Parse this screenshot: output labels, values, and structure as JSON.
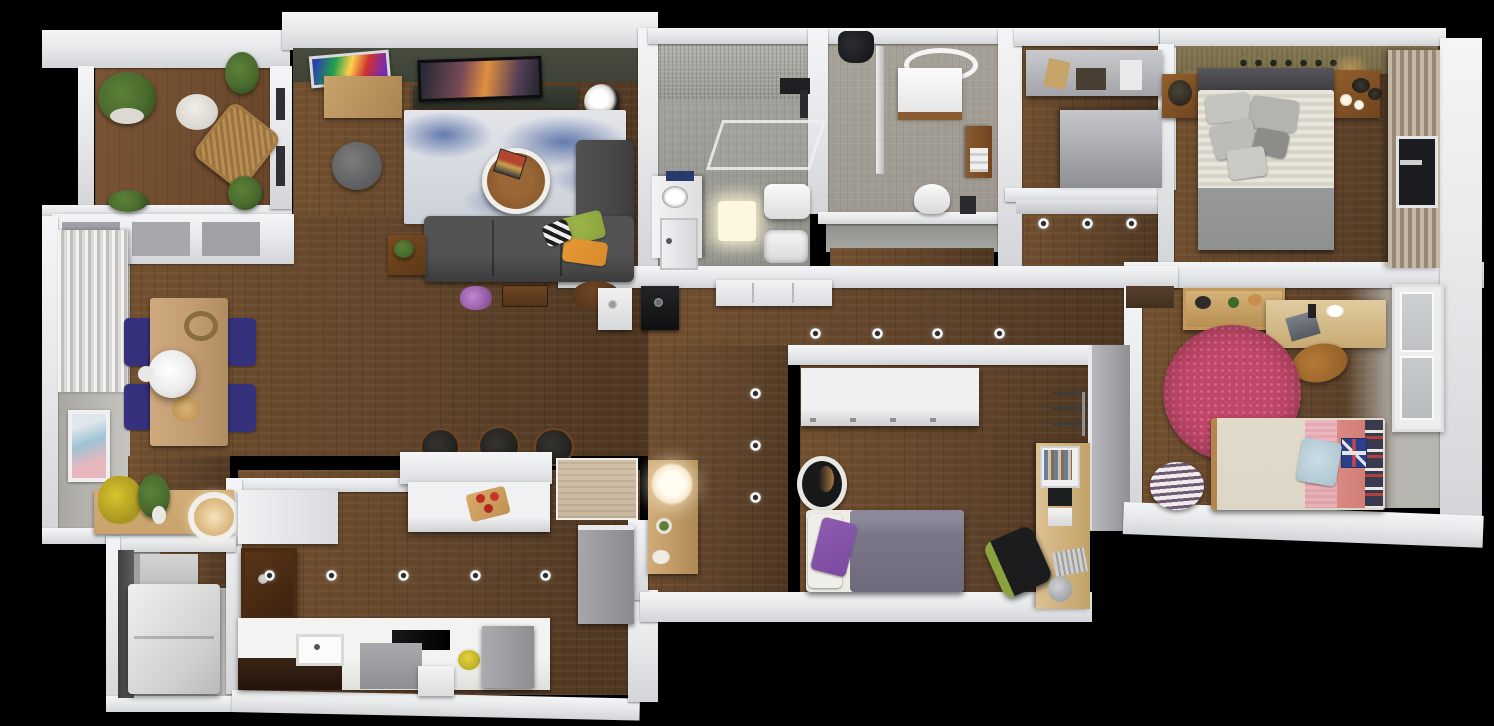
{
  "scene": {
    "type": "3d-floor-plan-top-down-render",
    "subject": "apartment-floor-plan",
    "background": "black",
    "visible_text": "none"
  },
  "palette": {
    "bg": "#000000",
    "wall": "#e8e9eb",
    "wood": "#5e422a",
    "woodDark": "#4c3520",
    "woodLight": "#73512f",
    "oliveWall": "#3e4337",
    "tanWall": "#7b6f4c",
    "tile": "#8f8f89",
    "tileLight": "#a9a9a3",
    "tile2": "#9d9890",
    "grayFloor": "#b7b5b0",
    "sofa": "#464646",
    "rugBase": "#dfe1e6",
    "rugBlue": "#637aad",
    "navy": "#36317c",
    "tableWood": "#c29c72",
    "lightWood": "#c9a36b",
    "darkWood": "#6f4520",
    "pinkRug": "#c14669",
    "bedCream": "#ddd6c7",
    "pinkPillow": "#e0a0aa",
    "redPillow": "#cf7a72",
    "duvetPurple": "#7b7789",
    "purplePillow": "#7b4a9e",
    "grayBlanket": "#8f9190",
    "glowWarm": "#f7ead0",
    "green": "#4a6b2e",
    "yellow": "#d8c42c",
    "orange": "#d9892b",
    "oliveGreen": "#8aa23c",
    "charcoal": "#232323",
    "grayBox": "#9a9b9e",
    "beigeMat": "#c9b79e",
    "white": "#f2f2f2",
    "closetGray": "#a3a4a9",
    "curtainDark": "#978975",
    "curtainLight": "#c4b8a6"
  },
  "rooms": [
    {
      "name": "balcony",
      "furniture": [
        "potted-plant-large",
        "potted-plant-small",
        "wicker-armchair",
        "white-floor-cushion",
        "shrubs"
      ]
    },
    {
      "name": "living-room",
      "furniture": [
        "accent-wall",
        "wall-art",
        "tv",
        "tv-stand",
        "wood-cabinet",
        "blue-area-rug",
        "round-coffee-table",
        "gray-sofa",
        "chaise",
        "bean-bag",
        "side-table",
        "throw-pillows"
      ]
    },
    {
      "name": "dining-area",
      "furniture": [
        "curtains",
        "dining-table",
        "navy-chair-1",
        "navy-chair-2",
        "navy-chair-3",
        "navy-chair-4",
        "pendant-lamp",
        "wall-art",
        "console-table",
        "yellow-flowers",
        "green-plant",
        "round-lamp"
      ]
    },
    {
      "name": "kitchen",
      "furniture": [
        "breakfast-bar",
        "island",
        "bar-stool-1",
        "bar-stool-2",
        "bar-stool-3",
        "cutting-board",
        "dark-wall-cabinet",
        "counter",
        "sink",
        "cooktop",
        "fridge",
        "tall-cabinet",
        "fruit-bowl",
        "entry-mat"
      ]
    },
    {
      "name": "laundry-room",
      "furniture": [
        "washer",
        "storage-box"
      ]
    },
    {
      "name": "bathroom-1",
      "furniture": [
        "walk-in-shower",
        "shower-head",
        "glass-screen",
        "vanity",
        "door",
        "glowing-bath-mat",
        "toilet",
        "bidet-sink"
      ]
    },
    {
      "name": "bathroom-2",
      "furniture": [
        "towel-robe",
        "glass-screen",
        "round-mirror",
        "vanity",
        "wood-shelf",
        "toilet",
        "waste-bin"
      ]
    },
    {
      "name": "walk-in-closet",
      "furniture": [
        "shelf-unit-top",
        "corner-unit"
      ]
    },
    {
      "name": "master-bedroom",
      "furniture": [
        "textured-accent-wall",
        "decor-shelf",
        "headboard",
        "double-bed",
        "gray-pillows",
        "foot-blanket",
        "nightstand-left",
        "nightstand-right",
        "curtains",
        "window"
      ]
    },
    {
      "name": "bedroom-2",
      "furniture": [
        "white-wardrobe",
        "round-planter",
        "single-bed",
        "purple-pillow",
        "desk",
        "book-shelf",
        "office-chair",
        "keyboard",
        "wall-hooks",
        "trash-bin"
      ]
    },
    {
      "name": "kids-bedroom",
      "furniture": [
        "doormat",
        "toy-bookshelf",
        "desk",
        "laptop",
        "wood-chair",
        "pink-round-rug",
        "single-bed",
        "union-jack-pillow",
        "striped-pouf",
        "window"
      ]
    },
    {
      "name": "hallway",
      "furniture": [
        "recessed-lights",
        "white-sideboard",
        "white-cabinet",
        "black-cabinet"
      ]
    },
    {
      "name": "entry",
      "furniture": [
        "console-table",
        "glowing-table-lamp",
        "decor"
      ]
    }
  ],
  "lighting": {
    "recessed_ceiling_lights_visible": 15,
    "glowing_lamps": [
      "entry-console-lamp",
      "dining-round-lamp",
      "bathroom-1-mat",
      "master-nightstand-glow"
    ]
  }
}
